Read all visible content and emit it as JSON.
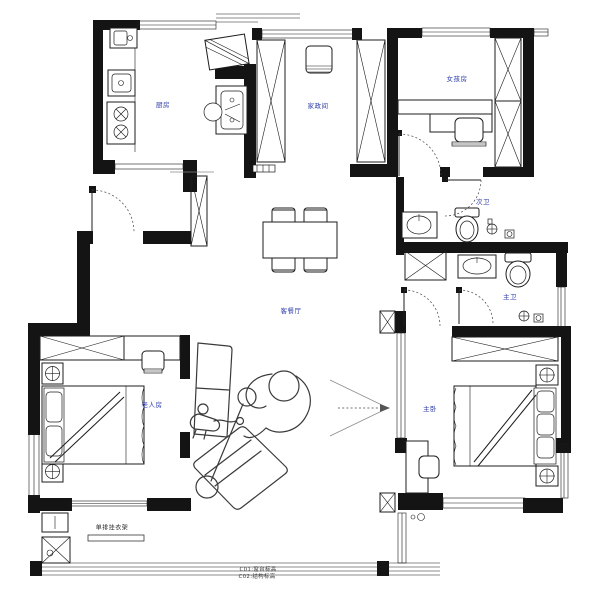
{
  "plan": {
    "title": "apartment-floor-plan",
    "rooms": [
      {
        "id": "kitchen",
        "label": "厨房"
      },
      {
        "id": "utility-room",
        "label": "家政间"
      },
      {
        "id": "girls-room",
        "label": "女孩房"
      },
      {
        "id": "second-bath",
        "label": "次卫"
      },
      {
        "id": "master-bath",
        "label": "主卫"
      },
      {
        "id": "living-dining",
        "label": "客餐厅"
      },
      {
        "id": "elder-room",
        "label": "老人房"
      },
      {
        "id": "master-bedroom",
        "label": "主卧"
      }
    ],
    "annotations": {
      "rack": "单排挂衣架",
      "note1": "C01:窗台标高",
      "note2": "C02:结构标高"
    },
    "colors": {
      "wall": "#141414",
      "label": "#2b3ba8",
      "sketch": "#3a3a3a",
      "background": "#ffffff"
    }
  }
}
